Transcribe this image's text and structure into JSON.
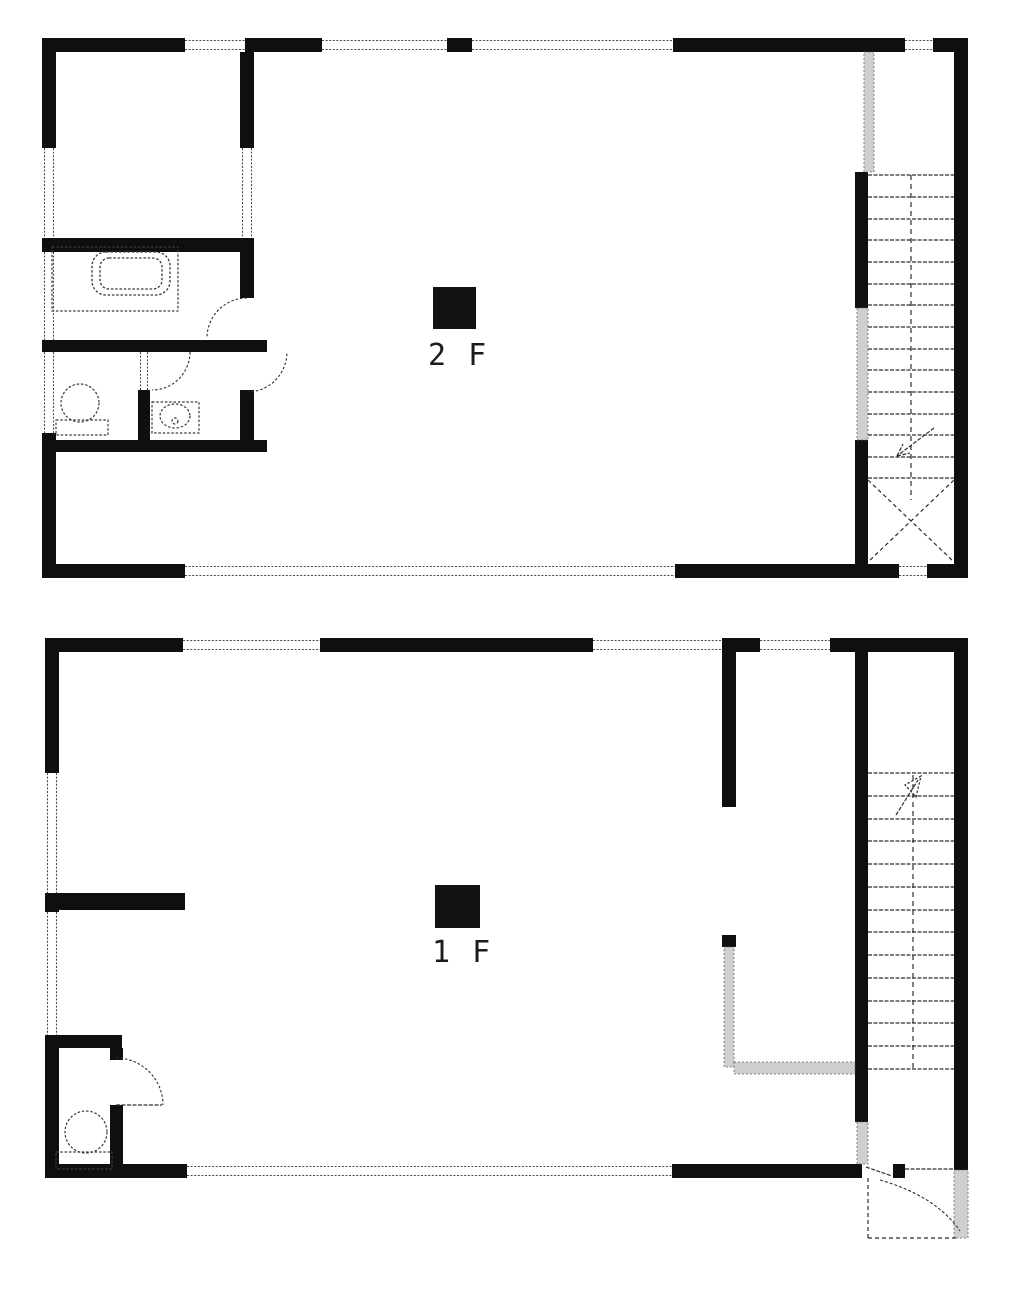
{
  "page": {
    "width": 1018,
    "height": 1294,
    "background": "#ffffff"
  },
  "colors": {
    "wall": "#0f0f0f",
    "line": "#2e2e2e",
    "fixture": "#3a3a3a",
    "win_line": "#4a4a4a",
    "lite_fill": "#cfcfcf",
    "lite_stroke": "#666666",
    "bg": "#ffffff",
    "text": "#1b1b1b",
    "marker": "#111111"
  },
  "floors": [
    {
      "name": "second-floor",
      "label": "2 F",
      "marker": {
        "x": 433,
        "y": 287,
        "w": 43,
        "h": 42
      },
      "label_pos": {
        "x": 428,
        "y": 341
      },
      "primitives": [
        {
          "t": "wall",
          "n": "exterior-wall-top",
          "x": 42,
          "y": 38,
          "w": 143,
          "h": 14
        },
        {
          "t": "wall",
          "n": "exterior-wall-top",
          "x": 245,
          "y": 38,
          "w": 77,
          "h": 14
        },
        {
          "t": "wall",
          "n": "exterior-wall-top",
          "x": 447,
          "y": 38,
          "w": 25,
          "h": 14
        },
        {
          "t": "wall",
          "n": "exterior-wall-top",
          "x": 673,
          "y": 38,
          "w": 232,
          "h": 14
        },
        {
          "t": "wall",
          "n": "exterior-wall-top",
          "x": 933,
          "y": 38,
          "w": 35,
          "h": 14
        },
        {
          "t": "wall",
          "n": "exterior-wall-left",
          "x": 42,
          "y": 38,
          "w": 14,
          "h": 110
        },
        {
          "t": "wall",
          "n": "exterior-wall-left",
          "x": 42,
          "y": 238,
          "w": 14,
          "h": 14
        },
        {
          "t": "wall",
          "n": "exterior-wall-left",
          "x": 42,
          "y": 340,
          "w": 14,
          "h": 12
        },
        {
          "t": "wall",
          "n": "exterior-wall-left",
          "x": 42,
          "y": 433,
          "w": 14,
          "h": 14
        },
        {
          "t": "wall",
          "n": "exterior-wall-left",
          "x": 42,
          "y": 447,
          "w": 14,
          "h": 131
        },
        {
          "t": "wall",
          "n": "exterior-wall-right",
          "x": 954,
          "y": 38,
          "w": 14,
          "h": 540
        },
        {
          "t": "wall",
          "n": "exterior-wall-bottom",
          "x": 42,
          "y": 564,
          "w": 143,
          "h": 14
        },
        {
          "t": "wall",
          "n": "exterior-wall-bottom",
          "x": 675,
          "y": 564,
          "w": 224,
          "h": 14
        },
        {
          "t": "wall",
          "n": "exterior-wall-bottom",
          "x": 927,
          "y": 564,
          "w": 41,
          "h": 14
        },
        {
          "t": "wall",
          "n": "interior-wall",
          "x": 240,
          "y": 38,
          "w": 14,
          "h": 110
        },
        {
          "t": "wall",
          "n": "interior-wall",
          "x": 240,
          "y": 238,
          "w": 14,
          "h": 14
        },
        {
          "t": "wall",
          "n": "interior-wall",
          "x": 240,
          "y": 252,
          "w": 14,
          "h": 46
        },
        {
          "t": "wall",
          "n": "interior-wall",
          "x": 240,
          "y": 390,
          "w": 14,
          "h": 62
        },
        {
          "t": "wall",
          "n": "interior-wall",
          "x": 42,
          "y": 238,
          "w": 212,
          "h": 14
        },
        {
          "t": "wall",
          "n": "interior-wall",
          "x": 42,
          "y": 340,
          "w": 225,
          "h": 12
        },
        {
          "t": "wall",
          "n": "interior-wall",
          "x": 42,
          "y": 440,
          "w": 225,
          "h": 12
        },
        {
          "t": "wall",
          "n": "interior-wall",
          "x": 138,
          "y": 390,
          "w": 12,
          "h": 50
        },
        {
          "t": "wall",
          "n": "stair-wall",
          "x": 855,
          "y": 172,
          "w": 13,
          "h": 136
        },
        {
          "t": "wall",
          "n": "stair-wall",
          "x": 855,
          "y": 440,
          "w": 13,
          "h": 124
        },
        {
          "t": "win",
          "n": "window",
          "x": 185,
          "y": 38,
          "w": 60,
          "h": 14
        },
        {
          "t": "win",
          "n": "window",
          "x": 322,
          "y": 38,
          "w": 125,
          "h": 14
        },
        {
          "t": "win",
          "n": "window",
          "x": 472,
          "y": 38,
          "w": 201,
          "h": 14
        },
        {
          "t": "win",
          "n": "window",
          "x": 905,
          "y": 38,
          "w": 28,
          "h": 14
        },
        {
          "t": "win",
          "n": "window",
          "x": 42,
          "y": 148,
          "w": 14,
          "h": 90
        },
        {
          "t": "win",
          "n": "window",
          "x": 42,
          "y": 252,
          "w": 14,
          "h": 88
        },
        {
          "t": "win",
          "n": "window",
          "x": 42,
          "y": 352,
          "w": 14,
          "h": 81
        },
        {
          "t": "win",
          "n": "window",
          "x": 185,
          "y": 564,
          "w": 490,
          "h": 14
        },
        {
          "t": "win",
          "n": "window",
          "x": 899,
          "y": 564,
          "w": 28,
          "h": 14
        },
        {
          "t": "win",
          "n": "interior-opening",
          "x": 240,
          "y": 148,
          "w": 14,
          "h": 90
        },
        {
          "t": "win",
          "n": "interior-opening",
          "x": 138,
          "y": 352,
          "w": 12,
          "h": 38
        },
        {
          "t": "lite",
          "n": "stair-rail",
          "x": 864,
          "y": 52,
          "w": 10,
          "h": 120
        },
        {
          "t": "lite",
          "n": "stair-half-wall",
          "x": 857,
          "y": 308,
          "w": 11,
          "h": 132
        },
        {
          "t": "line",
          "n": "stair-tread",
          "x1": 868,
          "y1": 175,
          "x2": 954,
          "y2": 175
        },
        {
          "t": "line",
          "n": "stair-tread",
          "x1": 868,
          "y1": 197,
          "x2": 954,
          "y2": 197
        },
        {
          "t": "line",
          "n": "stair-tread",
          "x1": 868,
          "y1": 219,
          "x2": 954,
          "y2": 219
        },
        {
          "t": "line",
          "n": "stair-tread",
          "x1": 868,
          "y1": 240,
          "x2": 954,
          "y2": 240
        },
        {
          "t": "line",
          "n": "stair-tread",
          "x1": 868,
          "y1": 262,
          "x2": 954,
          "y2": 262
        },
        {
          "t": "line",
          "n": "stair-tread",
          "x1": 868,
          "y1": 284,
          "x2": 954,
          "y2": 284
        },
        {
          "t": "line",
          "n": "stair-tread",
          "x1": 868,
          "y1": 305,
          "x2": 954,
          "y2": 305
        },
        {
          "t": "line",
          "n": "stair-tread",
          "x1": 868,
          "y1": 327,
          "x2": 954,
          "y2": 327
        },
        {
          "t": "line",
          "n": "stair-tread",
          "x1": 868,
          "y1": 349,
          "x2": 954,
          "y2": 349
        },
        {
          "t": "line",
          "n": "stair-tread",
          "x1": 868,
          "y1": 370,
          "x2": 954,
          "y2": 370
        },
        {
          "t": "line",
          "n": "stair-tread",
          "x1": 868,
          "y1": 392,
          "x2": 954,
          "y2": 392
        },
        {
          "t": "line",
          "n": "stair-tread",
          "x1": 868,
          "y1": 414,
          "x2": 954,
          "y2": 414
        },
        {
          "t": "line",
          "n": "stair-tread",
          "x1": 868,
          "y1": 435,
          "x2": 954,
          "y2": 435
        },
        {
          "t": "line",
          "n": "stair-tread",
          "x1": 868,
          "y1": 457,
          "x2": 954,
          "y2": 457
        },
        {
          "t": "line",
          "n": "stair-tread",
          "x1": 868,
          "y1": 478,
          "x2": 954,
          "y2": 478
        },
        {
          "t": "line",
          "n": "stair-centerline",
          "x1": 911,
          "y1": 175,
          "x2": 911,
          "y2": 500,
          "dash": "5 4"
        },
        {
          "t": "line",
          "n": "stair-arrow",
          "x1": 934,
          "y1": 428,
          "x2": 897,
          "y2": 456
        },
        {
          "t": "line",
          "n": "stair-arrow",
          "x1": 897,
          "y1": 456,
          "x2": 910,
          "y2": 453
        },
        {
          "t": "line",
          "n": "stair-arrow",
          "x1": 897,
          "y1": 456,
          "x2": 903,
          "y2": 444
        },
        {
          "t": "line",
          "n": "floor-opening-x",
          "x1": 868,
          "y1": 480,
          "x2": 954,
          "y2": 562,
          "dash": "4 3"
        },
        {
          "t": "line",
          "n": "floor-opening-x",
          "x1": 954,
          "y1": 480,
          "x2": 868,
          "y2": 562,
          "dash": "4 3"
        },
        {
          "t": "path",
          "n": "door-arc",
          "d": "M 247 298 A 40 40 0 0 0 207 338"
        },
        {
          "t": "path",
          "n": "door-arc",
          "d": "M 247 392 A 40 40 0 0 0 287 352"
        },
        {
          "t": "path",
          "n": "door-arc",
          "d": "M 190 352 A 38 38 0 0 1 152 390"
        },
        {
          "t": "rect",
          "n": "bath-platform",
          "x": 52,
          "y": 247,
          "w": 126,
          "h": 64
        },
        {
          "t": "rrect",
          "n": "bathtub",
          "x": 92,
          "y": 252,
          "w": 78,
          "h": 43,
          "rx": 14
        },
        {
          "t": "rrect",
          "n": "bathtub-inner",
          "x": 100,
          "y": 258,
          "w": 62,
          "h": 31,
          "rx": 9
        },
        {
          "t": "circle",
          "n": "toilet-bowl",
          "cx": 80,
          "cy": 403,
          "r": 19
        },
        {
          "t": "rect",
          "n": "toilet-tank",
          "x": 56,
          "y": 420,
          "w": 52,
          "h": 15
        },
        {
          "t": "rect",
          "n": "sink-counter",
          "x": 152,
          "y": 402,
          "w": 47,
          "h": 31
        },
        {
          "t": "ellipse",
          "n": "sink-basin",
          "cx": 175,
          "cy": 416,
          "rx": 15,
          "ry": 12
        },
        {
          "t": "circle",
          "n": "sink-drain",
          "cx": 175,
          "cy": 421,
          "r": 3
        }
      ]
    },
    {
      "name": "first-floor",
      "label": "1 F",
      "marker": {
        "x": 435,
        "y": 885,
        "w": 45,
        "h": 43
      },
      "label_pos": {
        "x": 432,
        "y": 938
      },
      "primitives": [
        {
          "t": "wall",
          "n": "exterior-wall-top",
          "x": 45,
          "y": 638,
          "w": 138,
          "h": 14
        },
        {
          "t": "wall",
          "n": "exterior-wall-top",
          "x": 320,
          "y": 638,
          "w": 273,
          "h": 14
        },
        {
          "t": "wall",
          "n": "exterior-wall-top",
          "x": 722,
          "y": 638,
          "w": 38,
          "h": 14
        },
        {
          "t": "wall",
          "n": "exterior-wall-top",
          "x": 830,
          "y": 638,
          "w": 138,
          "h": 14
        },
        {
          "t": "wall",
          "n": "exterior-wall-left",
          "x": 45,
          "y": 638,
          "w": 14,
          "h": 135
        },
        {
          "t": "wall",
          "n": "exterior-wall-left",
          "x": 45,
          "y": 893,
          "w": 14,
          "h": 19
        },
        {
          "t": "wall",
          "n": "exterior-wall-left",
          "x": 45,
          "y": 1035,
          "w": 14,
          "h": 143
        },
        {
          "t": "wall",
          "n": "exterior-wall-right",
          "x": 954,
          "y": 638,
          "w": 14,
          "h": 532
        },
        {
          "t": "wall",
          "n": "exterior-wall-bottom",
          "x": 45,
          "y": 1164,
          "w": 142,
          "h": 14
        },
        {
          "t": "wall",
          "n": "exterior-wall-bottom",
          "x": 672,
          "y": 1164,
          "w": 190,
          "h": 14
        },
        {
          "t": "wall",
          "n": "door-post",
          "x": 893,
          "y": 1164,
          "w": 12,
          "h": 14
        },
        {
          "t": "wall",
          "n": "interior-wall",
          "x": 722,
          "y": 652,
          "w": 14,
          "h": 155
        },
        {
          "t": "wall",
          "n": "stair-wall",
          "x": 855,
          "y": 652,
          "w": 13,
          "h": 470
        },
        {
          "t": "wall",
          "n": "interior-wall",
          "x": 45,
          "y": 893,
          "w": 140,
          "h": 17
        },
        {
          "t": "wall",
          "n": "toilet-room-wall",
          "x": 45,
          "y": 1035,
          "w": 77,
          "h": 13
        },
        {
          "t": "wall",
          "n": "toilet-room-wall",
          "x": 110,
          "y": 1048,
          "w": 13,
          "h": 12
        },
        {
          "t": "wall",
          "n": "toilet-room-wall",
          "x": 110,
          "y": 1105,
          "w": 13,
          "h": 73
        },
        {
          "t": "wall",
          "n": "counter-post",
          "x": 722,
          "y": 935,
          "w": 14,
          "h": 12
        },
        {
          "t": "win",
          "n": "window",
          "x": 183,
          "y": 638,
          "w": 137,
          "h": 14
        },
        {
          "t": "win",
          "n": "window",
          "x": 593,
          "y": 638,
          "w": 129,
          "h": 14
        },
        {
          "t": "win",
          "n": "window",
          "x": 760,
          "y": 638,
          "w": 70,
          "h": 14
        },
        {
          "t": "win",
          "n": "window",
          "x": 45,
          "y": 773,
          "w": 14,
          "h": 120
        },
        {
          "t": "win",
          "n": "window",
          "x": 45,
          "y": 912,
          "w": 14,
          "h": 123
        },
        {
          "t": "win",
          "n": "window",
          "x": 187,
          "y": 1164,
          "w": 485,
          "h": 14
        },
        {
          "t": "lite",
          "n": "counter",
          "x": 724,
          "y": 947,
          "w": 10,
          "h": 120
        },
        {
          "t": "lite",
          "n": "counter",
          "x": 734,
          "y": 1062,
          "w": 121,
          "h": 12
        },
        {
          "t": "lite",
          "n": "stair-door-opening",
          "x": 857,
          "y": 1122,
          "w": 11,
          "h": 42
        },
        {
          "t": "lite",
          "n": "porch-wall",
          "x": 954,
          "y": 1170,
          "w": 14,
          "h": 68
        },
        {
          "t": "line",
          "n": "stair-tread",
          "x1": 868,
          "y1": 773,
          "x2": 954,
          "y2": 773
        },
        {
          "t": "line",
          "n": "stair-tread",
          "x1": 868,
          "y1": 796,
          "x2": 954,
          "y2": 796
        },
        {
          "t": "line",
          "n": "stair-tread",
          "x1": 868,
          "y1": 819,
          "x2": 954,
          "y2": 819
        },
        {
          "t": "line",
          "n": "stair-tread",
          "x1": 868,
          "y1": 841,
          "x2": 954,
          "y2": 841
        },
        {
          "t": "line",
          "n": "stair-tread",
          "x1": 868,
          "y1": 864,
          "x2": 954,
          "y2": 864
        },
        {
          "t": "line",
          "n": "stair-tread",
          "x1": 868,
          "y1": 887,
          "x2": 954,
          "y2": 887
        },
        {
          "t": "line",
          "n": "stair-tread",
          "x1": 868,
          "y1": 910,
          "x2": 954,
          "y2": 910
        },
        {
          "t": "line",
          "n": "stair-tread",
          "x1": 868,
          "y1": 932,
          "x2": 954,
          "y2": 932
        },
        {
          "t": "line",
          "n": "stair-tread",
          "x1": 868,
          "y1": 955,
          "x2": 954,
          "y2": 955
        },
        {
          "t": "line",
          "n": "stair-tread",
          "x1": 868,
          "y1": 978,
          "x2": 954,
          "y2": 978
        },
        {
          "t": "line",
          "n": "stair-tread",
          "x1": 868,
          "y1": 1001,
          "x2": 954,
          "y2": 1001
        },
        {
          "t": "line",
          "n": "stair-tread",
          "x1": 868,
          "y1": 1023,
          "x2": 954,
          "y2": 1023
        },
        {
          "t": "line",
          "n": "stair-tread",
          "x1": 868,
          "y1": 1046,
          "x2": 954,
          "y2": 1046
        },
        {
          "t": "line",
          "n": "stair-tread",
          "x1": 868,
          "y1": 1069,
          "x2": 954,
          "y2": 1069
        },
        {
          "t": "line",
          "n": "stair-centerline",
          "x1": 913,
          "y1": 775,
          "x2": 913,
          "y2": 1069,
          "dash": "5 4"
        },
        {
          "t": "line",
          "n": "stair-arrow",
          "x1": 896,
          "y1": 815,
          "x2": 918,
          "y2": 780
        },
        {
          "t": "poly",
          "n": "stair-arrow-head",
          "pts": "921,776 905,785 916,797"
        },
        {
          "t": "line",
          "n": "porch-outline",
          "x1": 868,
          "y1": 1178,
          "x2": 868,
          "y2": 1238,
          "dash": "4 3"
        },
        {
          "t": "line",
          "n": "porch-outline",
          "x1": 868,
          "y1": 1238,
          "x2": 956,
          "y2": 1238,
          "dash": "4 3"
        },
        {
          "t": "line",
          "n": "threshold-line",
          "x1": 905,
          "y1": 1169,
          "x2": 954,
          "y2": 1169
        },
        {
          "t": "path",
          "n": "entry-door-arc",
          "d": "M 880 1180 Q 936 1196 960 1231",
          "dash": "3 2"
        },
        {
          "t": "line",
          "n": "entry-door-leaf",
          "x1": 866,
          "y1": 1167,
          "x2": 892,
          "y2": 1176
        },
        {
          "t": "line",
          "n": "door-leaf",
          "x1": 116,
          "y1": 1105,
          "x2": 162,
          "y2": 1105
        },
        {
          "t": "path",
          "n": "door-arc",
          "d": "M 116 1058 A 47 47 0 0 1 163 1105"
        },
        {
          "t": "circle",
          "n": "toilet-bowl",
          "cx": 86,
          "cy": 1132,
          "r": 21
        },
        {
          "t": "rect",
          "n": "toilet-tank",
          "x": 56,
          "y": 1152,
          "w": 56,
          "h": 17
        }
      ]
    }
  ]
}
